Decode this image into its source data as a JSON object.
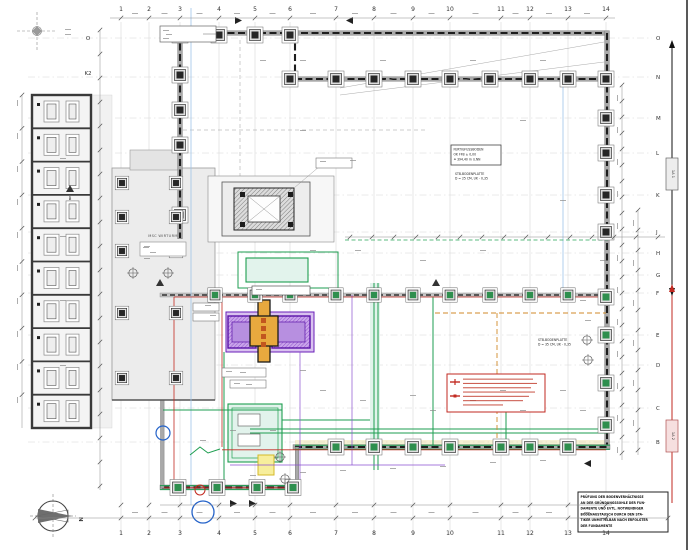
{
  "grid": {
    "columns": [
      {
        "label": "1",
        "x": 121
      },
      {
        "label": "2",
        "x": 149
      },
      {
        "label": "3",
        "x": 180
      },
      {
        "label": "4",
        "x": 219
      },
      {
        "label": "5",
        "x": 255
      },
      {
        "label": "6",
        "x": 290
      },
      {
        "label": "7",
        "x": 336
      },
      {
        "label": "8",
        "x": 374
      },
      {
        "label": "9",
        "x": 413
      },
      {
        "label": "10",
        "x": 450
      },
      {
        "label": "11",
        "x": 501
      },
      {
        "label": "12",
        "x": 530
      },
      {
        "label": "13",
        "x": 568
      },
      {
        "label": "14",
        "x": 606
      }
    ],
    "rows": [
      {
        "label": "O",
        "y": 38
      },
      {
        "label": "N",
        "y": 77
      },
      {
        "label": "M",
        "y": 118
      },
      {
        "label": "L",
        "y": 153
      },
      {
        "label": "K",
        "y": 195
      },
      {
        "label": "J",
        "y": 232
      },
      {
        "label": "H",
        "y": 253
      },
      {
        "label": "G",
        "y": 275
      },
      {
        "label": "F",
        "y": 293
      },
      {
        "label": "E",
        "y": 335
      },
      {
        "label": "D",
        "y": 365
      },
      {
        "label": "C",
        "y": 408
      },
      {
        "label": "B",
        "y": 442
      }
    ],
    "left_row_labels": [
      {
        "label": "O",
        "y": 38
      },
      {
        "label": "K2",
        "y": 73
      }
    ]
  },
  "labels": {
    "hall": "MSC WIRTURM",
    "north": "N",
    "section_b": "B",
    "section_1a1": "1A 1",
    "section_1a2": "1A 2"
  },
  "notes": {
    "ffb": [
      "FERTIGFUSSBODEN",
      "OK FFB ± 0,00",
      "≙ 394,40 m ü.NN"
    ],
    "plate_right_hall": [
      "STB-BODENPLATTE",
      "D = 25 CM, UK - 0,35"
    ],
    "plate_lower_hall": [
      "STB-BODENPLATTE",
      "D = 35 CM, UK - 0,35"
    ],
    "soil_check": [
      "PRÜFUNG DER BODENVERHÄLTNISSE",
      "AN DER GRÜNDUNGSSOHLE DER FUN-",
      "DAMENTE UND EVTL. NOTWENDIGER",
      "BODENAUSTAUSCH DURCH DEN STA-",
      "TIKER UNMITTELBAR NACH ERFOLGTER",
      "DER FUNDAMENTE"
    ]
  },
  "colors": {
    "wall_dark": "#1d1d1d",
    "wall_gray": "#a9a9a9",
    "hall_fill": "#ececec",
    "grid_line": "#cfcfcf",
    "green_pipe": "#1e9e50",
    "teal_fill": "#e2f3ec",
    "purple_outline": "#5a12a8",
    "purple_fill": "#c9a4ea",
    "orange": "#e8a93e",
    "red": "#c22a21",
    "blue": "#2563c9",
    "light_blue": "#9fc3e8",
    "yellow": "#e3cf6a"
  }
}
